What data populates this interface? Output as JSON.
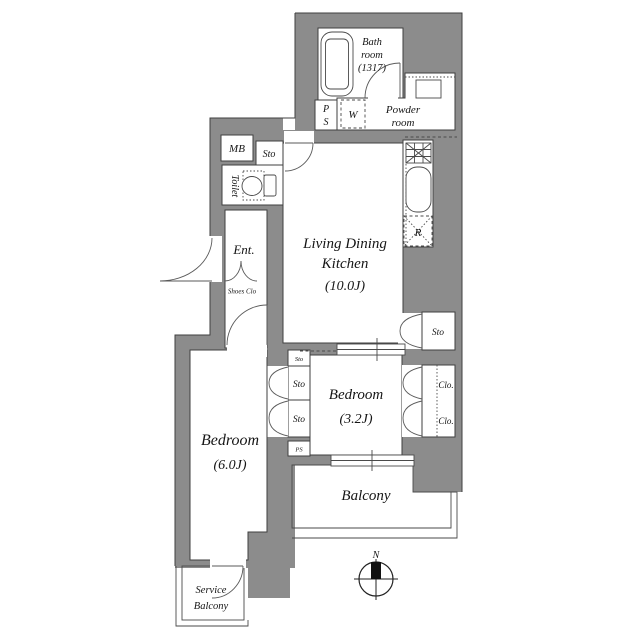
{
  "colors": {
    "wall": "#8c8c8c",
    "outline": "#3f3f3f",
    "text": "#151515",
    "background": "#ffffff"
  },
  "rooms": {
    "bath": {
      "l1": "Bath",
      "l2": "room",
      "l3": "(1317)"
    },
    "powder": {
      "l1": "Powder",
      "l2": "room"
    },
    "ldk": {
      "l1": "Living Dining",
      "l2": "Kitchen",
      "l3": "(10.0J)"
    },
    "bedroom_small": {
      "l1": "Bedroom",
      "l2": "(3.2J)"
    },
    "bedroom_large": {
      "l1": "Bedroom",
      "l2": "(6.0J)"
    },
    "balcony": {
      "l1": "Balcony"
    },
    "service_balcony": {
      "l1": "Service",
      "l2": "Balcony"
    },
    "toilet": {
      "l1": "Toilet"
    },
    "entrance": {
      "l1": "Ent."
    },
    "shoes_closet": {
      "l1": "Shoes Clo"
    }
  },
  "fixtures": {
    "meter_box": "MB",
    "pipe_shaft_p": "P",
    "pipe_shaft_s": "S",
    "washer": "W",
    "refrigerator": "R",
    "pipe_space_small": "PS",
    "storage_hall": "Sto",
    "storage_ldk": "Sto",
    "storage_top_small": "Sto",
    "storage_mid": "Sto",
    "storage_low": "Sto",
    "closet_top": "Clo.",
    "closet_bottom": "Clo."
  },
  "compass": {
    "north": "N"
  }
}
